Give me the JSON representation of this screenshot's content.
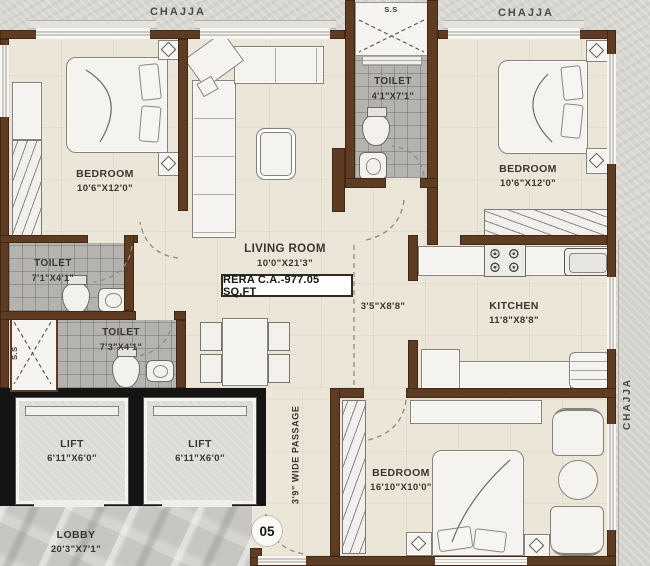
{
  "labels": {
    "chajja": "CHAJJA",
    "ss": "S.S",
    "rera": "RERA C.A.-977.05 SQ.FT",
    "unit_number": "05",
    "passage_dims": "3'5\"X8'8\"",
    "wide_passage": "3'9\" WIDE PASSAGE"
  },
  "rooms": {
    "bedroom1": {
      "name": "BEDROOM",
      "dims": "10'6\"X12'0\""
    },
    "bedroom2": {
      "name": "BEDROOM",
      "dims": "10'6\"X12'0\""
    },
    "bedroom3": {
      "name": "BEDROOM",
      "dims": "16'10\"X10'0\""
    },
    "toilet_top": {
      "name": "TOILET",
      "dims": "4'1\"X7'1\""
    },
    "toilet_mid": {
      "name": "TOILET",
      "dims": "7'1\"X4'1\""
    },
    "toilet_low": {
      "name": "TOILET",
      "dims": "7'3\"X4'1\""
    },
    "living": {
      "name": "LIVING ROOM",
      "dims": "10'0\"X21'3\""
    },
    "kitchen": {
      "name": "KITCHEN",
      "dims": "11'8\"X8'8\""
    },
    "lift": {
      "name": "LIFT",
      "dims": "6'11\"X6'0\""
    },
    "lobby": {
      "name": "LOBBY",
      "dims": "20'3\"X7'1\""
    }
  },
  "colors": {
    "wall": "#5e3b23",
    "floor": "#ece6d9",
    "outside": "#d7d6d1",
    "toilet_tile": "#b4b3af",
    "lift_block": "#141414",
    "lobby_marble": "#c7c6c2"
  }
}
